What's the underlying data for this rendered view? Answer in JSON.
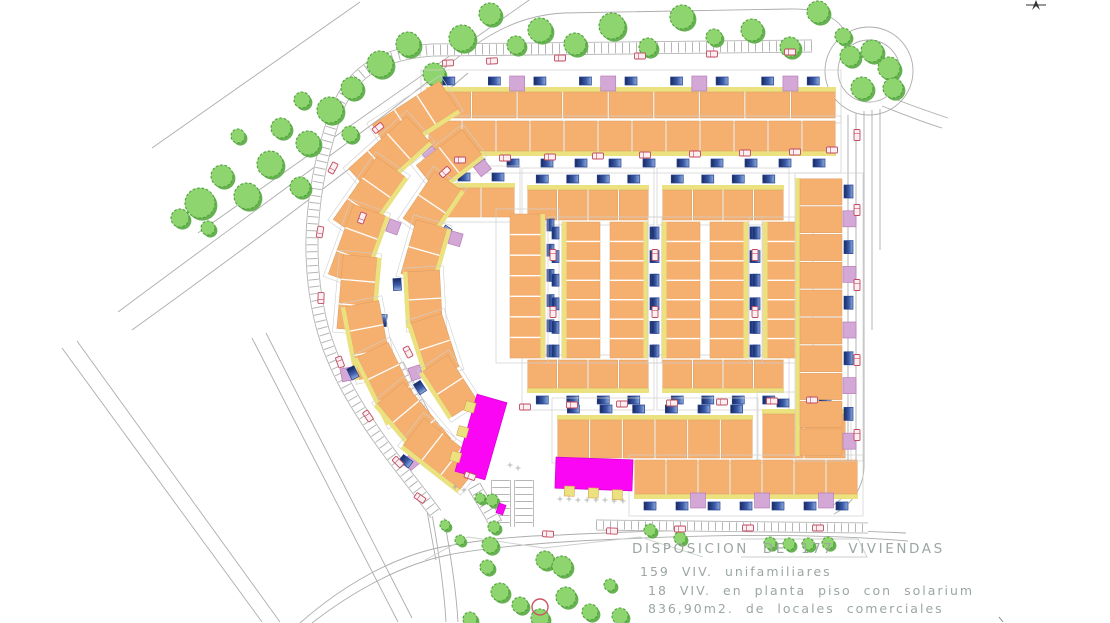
{
  "legend": {
    "line1": "DISPOSICION DE 177 VIVIENDAS",
    "line2": "159 VIV. unifamiliares",
    "line3": "18 VIV. en planta piso con solarium",
    "line4": "836,90m2. de locales comerciales"
  },
  "colors": {
    "orange": "#F5B070",
    "orangeStroke": "#DA9C5E",
    "yellow": "#EBE17F",
    "lilac": "#D3A7D6",
    "lilacStroke": "#B77FB8",
    "poolDark": "#16295F",
    "poolMid": "#3B5AA8",
    "poolLight": "#8FAEDC",
    "poolStroke": "#26418F",
    "tree": "#8FD56F",
    "treeShadow": "#66B152",
    "treeStroke": "#4FA23C",
    "road": "#ACACAC",
    "plot": "#CFCFCF",
    "car": "#C04A60",
    "carFill": "#FBEFF1",
    "magenta": "#FB06F5",
    "magentaStroke": "#D800D8",
    "red": "#CC5566",
    "text": "#9CA7A1",
    "parkLine": "#C9CFC9",
    "compass": "#333333"
  },
  "scene": {
    "roads": [
      "M152,148 L360,2",
      "M198,233 L532,-2",
      "M118,312 C260,206 382,120 452,62 C492,30 524,15 564,13 L790,9 C818,8 836,17 844,30",
      "M132,330 C282,222 402,130 468,73",
      "M62,348 L262,622",
      "M77,341 L280,622",
      "M252,338 L398,622",
      "M266,333 L412,618",
      "M300,623 C342,586 392,557 442,547 C484,539 520,536 560,535 C700,528 800,528 906,533",
      "M312,623 C352,592 400,565 448,555 C488,547 560,541 622,539 C724,534 824,534 908,541",
      "M848,115 L848,462 C848,480 838,494 822,502",
      "M856,113 L856,464 C856,484 844,500 828,508",
      "M864,111 L864,466 C864,488 850,506 834,514",
      "M872,110 L872,330",
      "M880,109 L880,250",
      "M882,106 C902,114 922,122 942,128",
      "M890,97 C910,105 930,112 948,118",
      "M444,518 C450,552 456,588 458,622",
      "M432,514 C438,548 444,586 446,622",
      "M424,494 C428,516 432,540 436,560"
    ],
    "roundabout": {
      "cx": 869,
      "cy": 71,
      "ri": 31,
      "ro": 44
    },
    "ladders": [
      {
        "d": "M812,46 L432,50 C378,54 348,74 334,118 C310,190 306,258 320,318 C330,362 352,400 380,440 C400,468 420,492 436,514",
        "w": 13
      },
      {
        "d": "M596,525 L868,528",
        "w": 11
      },
      {
        "d": "M501,480 L501,527",
        "w": 20
      },
      {
        "d": "M524,480 L524,527",
        "w": 20
      },
      {
        "d": "M474,486 C482,500 490,512 496,524",
        "w": 14
      },
      {
        "d": "M398,364 C416,398 434,434 452,470",
        "w": 12
      }
    ],
    "park_lines": [
      "M425,560 L468,537 L544,548 L640,537 L703,557",
      "M741,539 L858,539 L867,557 L741,557"
    ],
    "trees": [
      [
        200,
        203,
        15
      ],
      [
        222,
        176,
        11
      ],
      [
        247,
        196,
        13
      ],
      [
        270,
        164,
        13
      ],
      [
        281,
        128,
        10
      ],
      [
        300,
        187,
        10
      ],
      [
        308,
        143,
        12
      ],
      [
        330,
        110,
        13
      ],
      [
        302,
        100,
        8
      ],
      [
        352,
        88,
        11
      ],
      [
        380,
        64,
        13
      ],
      [
        350,
        134,
        8
      ],
      [
        408,
        44,
        12
      ],
      [
        434,
        74,
        11
      ],
      [
        462,
        38,
        13
      ],
      [
        490,
        14,
        11
      ],
      [
        516,
        45,
        9
      ],
      [
        208,
        228,
        7
      ],
      [
        238,
        136,
        7
      ],
      [
        180,
        218,
        9
      ],
      [
        540,
        30,
        12
      ],
      [
        575,
        44,
        11
      ],
      [
        612,
        26,
        13
      ],
      [
        648,
        47,
        9
      ],
      [
        682,
        17,
        12
      ],
      [
        714,
        37,
        8
      ],
      [
        752,
        30,
        11
      ],
      [
        790,
        47,
        10
      ],
      [
        818,
        12,
        11
      ],
      [
        843,
        36,
        8
      ],
      [
        850,
        56,
        10
      ],
      [
        872,
        51,
        11
      ],
      [
        889,
        68,
        11
      ],
      [
        862,
        88,
        11
      ],
      [
        893,
        88,
        10
      ],
      [
        490,
        545,
        8
      ],
      [
        487,
        567,
        7
      ],
      [
        500,
        592,
        9
      ],
      [
        520,
        605,
        8
      ],
      [
        545,
        560,
        9
      ],
      [
        562,
        566,
        10
      ],
      [
        566,
        597,
        10
      ],
      [
        540,
        618,
        9
      ],
      [
        590,
        612,
        8
      ],
      [
        620,
        616,
        8
      ],
      [
        470,
        619,
        7
      ],
      [
        610,
        585,
        6
      ],
      [
        650,
        530,
        6
      ],
      [
        680,
        538,
        6
      ],
      [
        445,
        525,
        5
      ],
      [
        460,
        540,
        5
      ],
      [
        494,
        527,
        6
      ],
      [
        480,
        498,
        5
      ],
      [
        492,
        500,
        6
      ],
      [
        770,
        543,
        6
      ],
      [
        789,
        544,
        6
      ],
      [
        808,
        544,
        6
      ],
      [
        828,
        543,
        6
      ]
    ],
    "rows": [
      {
        "x": 426,
        "y": 92,
        "w": 410,
        "h": 26,
        "units": 9,
        "yellow": "top",
        "pools": "top",
        "purple": "top"
      },
      {
        "x": 428,
        "y": 121,
        "w": 408,
        "h": 30,
        "units": 12,
        "yellow": "bottom",
        "pools": "bottom",
        "purple": ""
      },
      {
        "x": 447,
        "y": 188,
        "w": 68,
        "h": 29,
        "units": 2,
        "yellow": "top",
        "pools": "top",
        "purple": ""
      },
      {
        "x": 527,
        "y": 190,
        "w": 122,
        "h": 30,
        "units": 4,
        "yellow": "top",
        "pools": "top",
        "purple": ""
      },
      {
        "x": 662,
        "y": 190,
        "w": 122,
        "h": 30,
        "units": 4,
        "yellow": "top",
        "pools": "top",
        "purple": ""
      },
      {
        "x": 527,
        "y": 360,
        "w": 122,
        "h": 28,
        "units": 4,
        "yellow": "bottom",
        "pools": "bottom",
        "purple": ""
      },
      {
        "x": 662,
        "y": 360,
        "w": 122,
        "h": 28,
        "units": 4,
        "yellow": "bottom",
        "pools": "bottom",
        "purple": ""
      },
      {
        "x": 557,
        "y": 420,
        "w": 196,
        "h": 38,
        "units": 6,
        "yellow": "top",
        "pools": "top",
        "purple": ""
      },
      {
        "x": 762,
        "y": 414,
        "w": 84,
        "h": 44,
        "units": 2,
        "yellow": "top",
        "pools": "top",
        "purple": ""
      },
      {
        "x": 634,
        "y": 460,
        "w": 224,
        "h": 34,
        "units": 7,
        "yellow": "bottom",
        "pools": "bottom",
        "purple": "bottom"
      }
    ],
    "vstrips": [
      {
        "x": 510,
        "y": 214,
        "w": 35,
        "h": 144,
        "units": 7,
        "pools": "right",
        "double": false
      },
      {
        "x": 562,
        "y": 222,
        "w": 86,
        "h": 136,
        "units": 7,
        "pools": "both",
        "double": true
      },
      {
        "x": 662,
        "y": 222,
        "w": 86,
        "h": 136,
        "units": 7,
        "pools": "both",
        "double": true
      },
      {
        "x": 763,
        "y": 222,
        "w": 36,
        "h": 136,
        "units": 7,
        "pools": "left",
        "double": false
      }
    ],
    "ecol": {
      "x": 800,
      "y": 178,
      "w": 42,
      "h": 278,
      "units": 10
    },
    "fan": [
      [
        415,
        117,
        80,
        34,
        -33
      ],
      [
        389,
        155,
        78,
        34,
        -42
      ],
      [
        369,
        198,
        76,
        34,
        -55
      ],
      [
        357,
        245,
        74,
        34,
        -70
      ],
      [
        357,
        293,
        74,
        34,
        -85
      ],
      [
        369,
        340,
        74,
        34,
        79
      ],
      [
        389,
        383,
        74,
        34,
        64
      ],
      [
        414,
        421,
        74,
        34,
        50
      ],
      [
        442,
        454,
        72,
        34,
        38
      ],
      [
        449,
        160,
        58,
        32,
        -38
      ],
      [
        432,
        204,
        56,
        32,
        -56
      ],
      [
        424,
        251,
        56,
        32,
        -74
      ],
      [
        425,
        299,
        56,
        32,
        87
      ],
      [
        435,
        345,
        56,
        32,
        72
      ],
      [
        450,
        386,
        54,
        30,
        57
      ]
    ],
    "magenta": [
      {
        "cx": 481,
        "cy": 437,
        "w": 31,
        "h": 80,
        "rot": 16,
        "tabs": [
          [
            -19,
            -26
          ],
          [
            -19,
            0
          ],
          [
            -19,
            26
          ]
        ]
      },
      {
        "cx": 594,
        "cy": 474,
        "w": 77,
        "h": 31,
        "rot": 2,
        "tabs": [
          [
            -24,
            18
          ],
          [
            0,
            19
          ],
          [
            24,
            20
          ]
        ]
      },
      {
        "cx": 501,
        "cy": 509,
        "w": 7,
        "h": 10,
        "rot": 20,
        "tabs": []
      }
    ],
    "cars": [
      [
        448,
        63,
        -3
      ],
      [
        492,
        61,
        -3
      ],
      [
        560,
        58,
        0
      ],
      [
        640,
        56,
        0
      ],
      [
        712,
        54,
        0
      ],
      [
        790,
        52,
        0
      ],
      [
        460,
        160,
        0
      ],
      [
        505,
        158,
        0
      ],
      [
        550,
        157,
        0
      ],
      [
        598,
        156,
        0
      ],
      [
        645,
        155,
        0
      ],
      [
        695,
        154,
        0
      ],
      [
        745,
        153,
        0
      ],
      [
        795,
        152,
        0
      ],
      [
        832,
        150,
        0
      ],
      [
        525,
        407,
        0
      ],
      [
        572,
        405,
        0
      ],
      [
        622,
        404,
        0
      ],
      [
        672,
        403,
        0
      ],
      [
        722,
        402,
        0
      ],
      [
        772,
        401,
        0
      ],
      [
        812,
        400,
        0
      ],
      [
        857,
        135,
        90
      ],
      [
        857,
        210,
        90
      ],
      [
        857,
        285,
        90
      ],
      [
        857,
        360,
        90
      ],
      [
        857,
        435,
        90
      ],
      [
        333,
        168,
        -62
      ],
      [
        320,
        232,
        -80
      ],
      [
        321,
        298,
        -88
      ],
      [
        340,
        362,
        70
      ],
      [
        368,
        416,
        55
      ],
      [
        398,
        462,
        45
      ],
      [
        420,
        498,
        35
      ],
      [
        548,
        534,
        3
      ],
      [
        612,
        531,
        2
      ],
      [
        680,
        529,
        0
      ],
      [
        748,
        528,
        0
      ],
      [
        818,
        528,
        0
      ],
      [
        553,
        255,
        90
      ],
      [
        553,
        312,
        90
      ],
      [
        655,
        255,
        90
      ],
      [
        655,
        312,
        90
      ],
      [
        755,
        255,
        90
      ],
      [
        755,
        312,
        90
      ],
      [
        470,
        476,
        20
      ],
      [
        445,
        172,
        -42
      ],
      [
        378,
        128,
        -38
      ],
      [
        362,
        218,
        -70
      ],
      [
        408,
        352,
        62
      ]
    ],
    "sparkles": [
      [
        560,
        499
      ],
      [
        569,
        499
      ],
      [
        578,
        500
      ],
      [
        587,
        500
      ],
      [
        596,
        500
      ],
      [
        605,
        500
      ],
      [
        614,
        501
      ],
      [
        623,
        501
      ],
      [
        455,
        487
      ],
      [
        464,
        490
      ],
      [
        510,
        465
      ],
      [
        518,
        468
      ]
    ],
    "red_circle": {
      "cx": 540,
      "cy": 607,
      "r": 8
    },
    "compass": {
      "x": 1036,
      "y": 0
    }
  }
}
